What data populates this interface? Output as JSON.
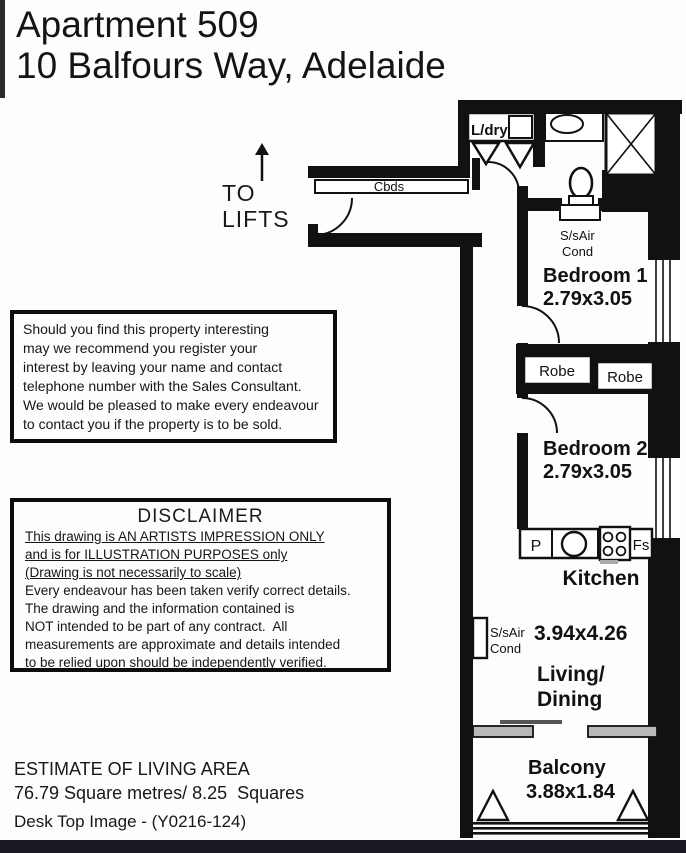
{
  "header": {
    "title_line1": "Apartment 509",
    "title_line2": "10 Balfours Way, Adelaide"
  },
  "wayfinding": {
    "line1": "TO",
    "line2": "LIFTS"
  },
  "register_box": {
    "lines": [
      "Should you find this property interesting",
      "may we recommend you register your",
      "interest by leaving your name and contact",
      "telephone number with the Sales Consultant.",
      "We would be pleased to make every endeavour",
      "to contact you if the property is to be sold."
    ]
  },
  "disclaimer_box": {
    "title": "DISCLAIMER",
    "underlined_lines": [
      "This drawing is AN ARTISTS IMPRESSION ONLY",
      "and is for ILLUSTRATION PURPOSES only",
      "(Drawing is not necessarily to scale)"
    ],
    "lines": [
      "Every endeavour has been taken verify correct details.",
      "The drawing and the information contained is",
      "NOT intended to be part of any contract.  All",
      "measurements are approximate and details intended",
      "to be relied upon should be independently verified."
    ]
  },
  "estimate": {
    "line1": "ESTIMATE OF LIVING AREA",
    "line2": "76.79 Square metres/ 8.25  Squares"
  },
  "footer": {
    "reference": "Desk Top Image - (Y0216-124)"
  },
  "floorplan": {
    "labels": {
      "cupboards": "Cbds",
      "laundry": "L/dry",
      "aircon1_line1": "S/sAir",
      "aircon1_line2": "Cond",
      "bedroom1_name": "Bedroom 1",
      "bedroom1_dims": "2.79x3.05",
      "robe_left": "Robe",
      "robe_right": "Robe",
      "bedroom2_name": "Bedroom 2",
      "bedroom2_dims": "2.79x3.05",
      "pantry": "P",
      "fridge_space": "Fs",
      "kitchen": "Kitchen",
      "living_dims": "3.94x4.26",
      "aircon2_line1": "S/sAir",
      "aircon2_line2": "Cond",
      "living_line1": "Living/",
      "living_line2": "Dining",
      "balcony_name": "Balcony",
      "balcony_dims": "3.88x1.84"
    }
  },
  "colors": {
    "wall": "#111111",
    "bottom_bar": "#1a1a22",
    "divider_gray": "#b9b9b9"
  }
}
